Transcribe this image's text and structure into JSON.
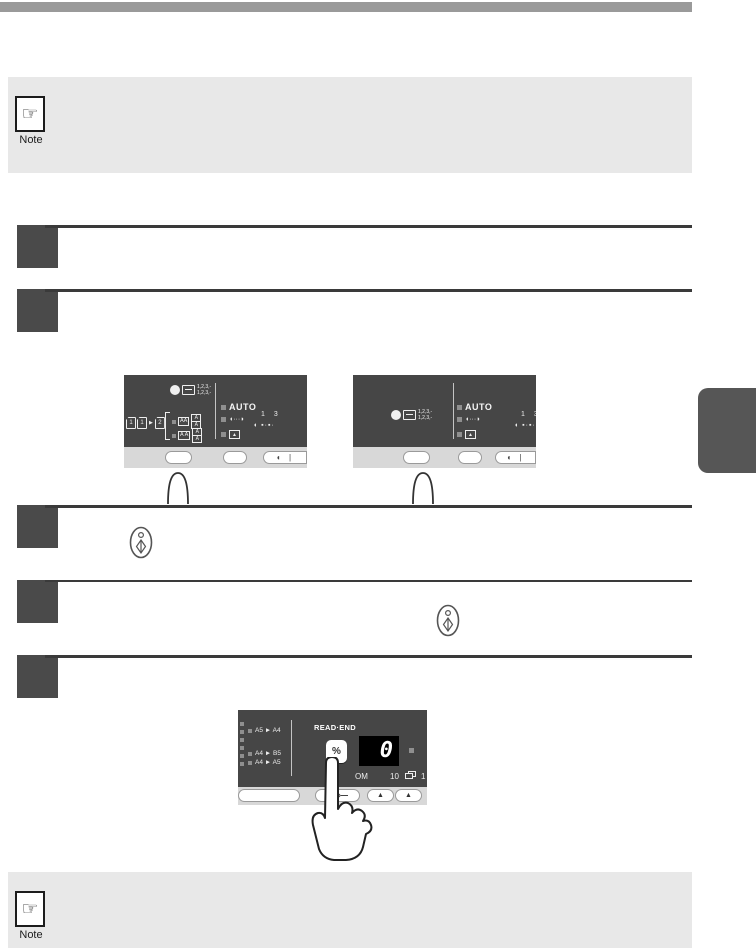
{
  "colors": {
    "header_bar": "#9a9a9a",
    "note_bg": "#e8e8e8",
    "step_box": "#4a4a4a",
    "rule_line": "#3a3a3a",
    "panel_dark": "#464646",
    "panel_strip": "#d8d8d8",
    "side_tab": "#565656",
    "display_bg": "#000000",
    "display_digit": "#ffffff",
    "led": "#8f8f8f"
  },
  "note_top": {
    "icon": "pointing-hand-icon",
    "glyph": "☞",
    "label": "Note"
  },
  "note_bottom": {
    "icon": "pointing-hand-icon",
    "glyph": "☞",
    "label": "Note"
  },
  "start_key_icon": {
    "name": "start-key-icon"
  },
  "panel_left": {
    "sort_icon": {
      "name": "sort-copies-icon",
      "line1": "1,2,3,-",
      "line2": "1,2,3,-"
    },
    "originals": {
      "page1": "1",
      "page2": "1",
      "arrow": "▶",
      "page3": "2",
      "bracket": "[",
      "row1_box": "AA",
      "row1_stack_top": "A",
      "row1_stack_bottom": "A",
      "row2_box": "A A",
      "row2_stack_top": "A",
      "row2_stack_bottom": "A"
    },
    "auto_label": "AUTO",
    "exposure_glyph": "◖···◗",
    "density_left": "1",
    "density_right": "3",
    "density_scale": "◖ ▪·▪·",
    "strip_contrast": "◖ |"
  },
  "panel_right": {
    "sort_icon": {
      "name": "sort-copies-icon",
      "line1": "1,2,3,-",
      "line2": "1,2,3,-"
    },
    "auto_label": "AUTO",
    "exposure_glyph": "◖···◗",
    "density_left": "1",
    "density_right": "3",
    "density_scale": "◖ ▪·▪·",
    "strip_contrast": "◖ |"
  },
  "panel_readend": {
    "title": "READ·END",
    "percent_key": "%",
    "display_value": "0",
    "zoom_label_visible": "OM",
    "count_left": "10",
    "count_right": "1",
    "ratios": [
      "A5 ► A4",
      "A4 ► B5",
      "A4 ► A5"
    ],
    "up_key": "▲"
  }
}
